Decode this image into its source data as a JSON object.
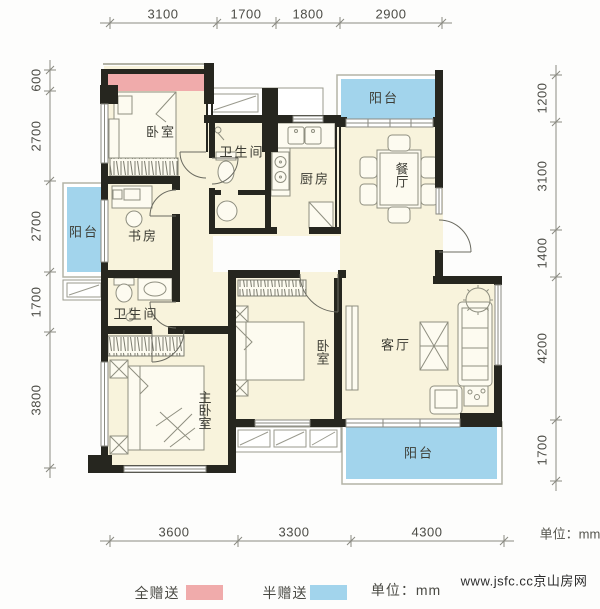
{
  "plan": {
    "rooms": [
      {
        "id": "bedroom-top",
        "label": "卧室"
      },
      {
        "id": "bath-top",
        "label": "卫生间"
      },
      {
        "id": "kitchen",
        "label": "厨房"
      },
      {
        "id": "dining",
        "label": "餐厅"
      },
      {
        "id": "balcony-top",
        "label": "阳台"
      },
      {
        "id": "study",
        "label": "书房"
      },
      {
        "id": "balcony-left",
        "label": "阳台"
      },
      {
        "id": "bath-mid",
        "label": "卫生间"
      },
      {
        "id": "master-bedroom",
        "label": "主卧室"
      },
      {
        "id": "bedroom-mid",
        "label": "卧室"
      },
      {
        "id": "living",
        "label": "客厅"
      },
      {
        "id": "balcony-bottom",
        "label": "阳台"
      }
    ],
    "dimensions": {
      "top": [
        "3100",
        "1700",
        "1800",
        "2900"
      ],
      "left": [
        "600",
        "2700",
        "2700",
        "1700",
        "3800"
      ],
      "right": [
        "1200",
        "3100",
        "1400",
        "4200",
        "1700"
      ],
      "bottom": [
        "3600",
        "3300",
        "4300"
      ],
      "unit_note": "单位：mm"
    },
    "colors": {
      "full_gift": "#f0abab",
      "half_gift": "#a2d4ec",
      "floor": "#f8f3dc",
      "wall": "#26261f"
    }
  },
  "legend": {
    "items": [
      {
        "label": "全赠送",
        "color": "#f0abab"
      },
      {
        "label": "半赠送",
        "color": "#a2d4ec"
      }
    ],
    "unit_note": "单位：mm"
  },
  "watermark": "www.jsfc.cc京山房网"
}
